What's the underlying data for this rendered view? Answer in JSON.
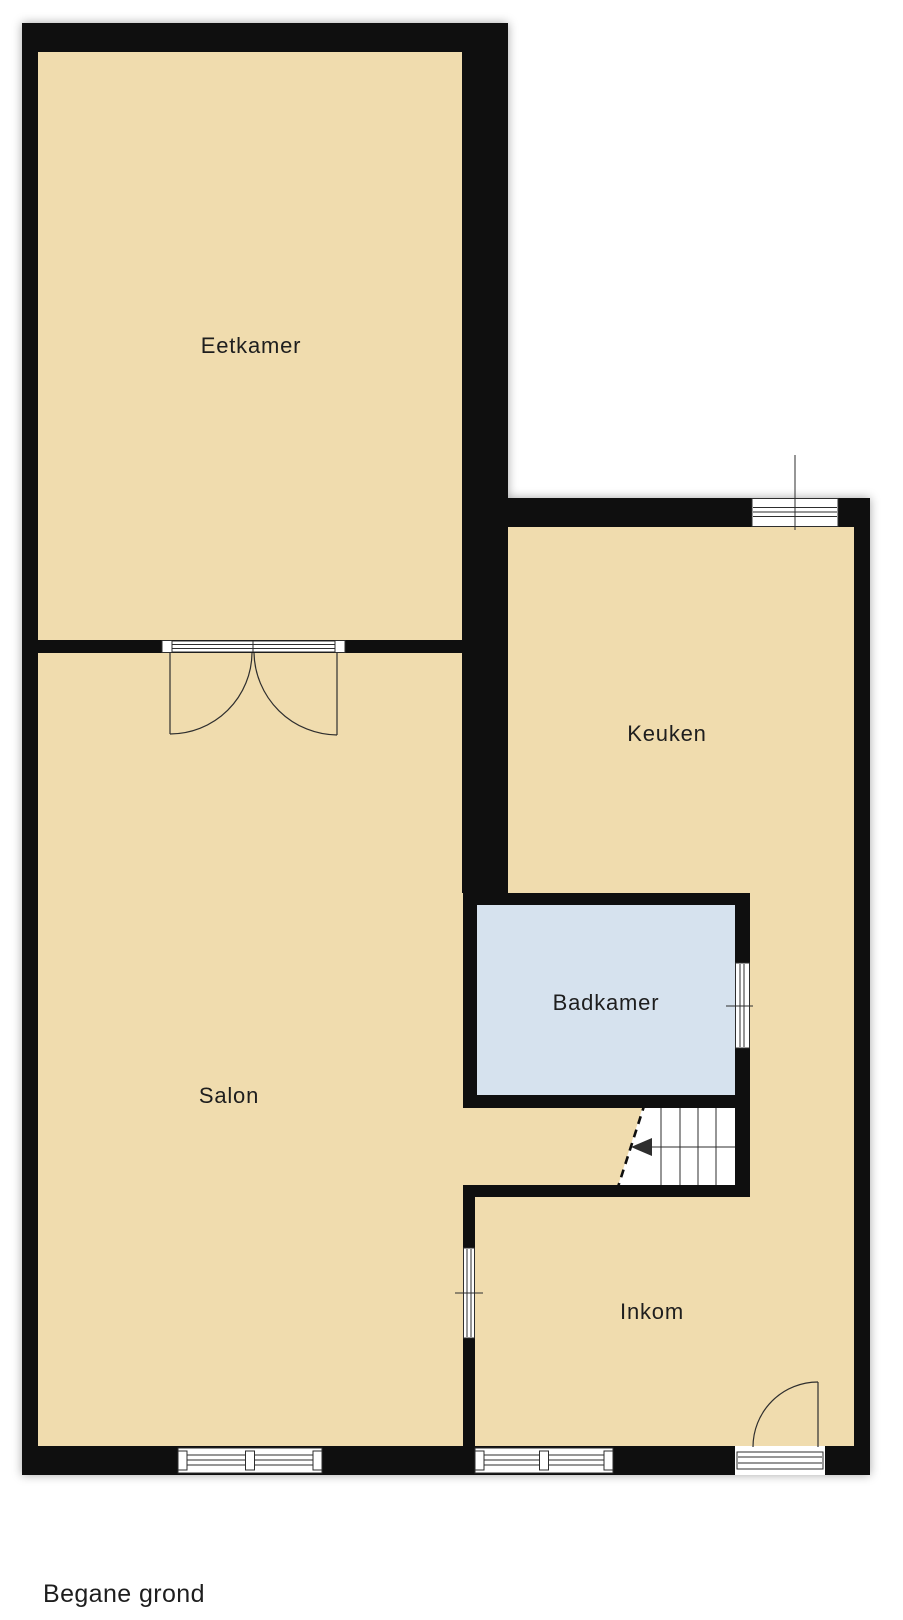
{
  "title": {
    "label": "Begane grond"
  },
  "rooms": {
    "eetkamer": {
      "label": "Eetkamer"
    },
    "keuken": {
      "label": "Keuken"
    },
    "badkamer": {
      "label": "Badkamer"
    },
    "salon": {
      "label": "Salon"
    },
    "inkom": {
      "label": "Inkom"
    }
  },
  "features": {
    "double_door": "double-swing-door between Eetkamer and Salon",
    "entrance_door": "entrance door in Inkom bottom wall",
    "staircase": "staircase beside Badkamer with up-arrow pointing left",
    "windows": [
      "keuken-top-window",
      "badkamer-side-window",
      "salon-inkom-window",
      "salon-bottom-window",
      "inkom-bottom-window"
    ]
  },
  "colors": {
    "background": "#ffffff",
    "floor": "#f0dcae",
    "wet_room_floor": "#d6e2ee",
    "wall": "#0f0f0f",
    "symbol_line": "#2e2e2e",
    "text": "#1e1e1e"
  }
}
